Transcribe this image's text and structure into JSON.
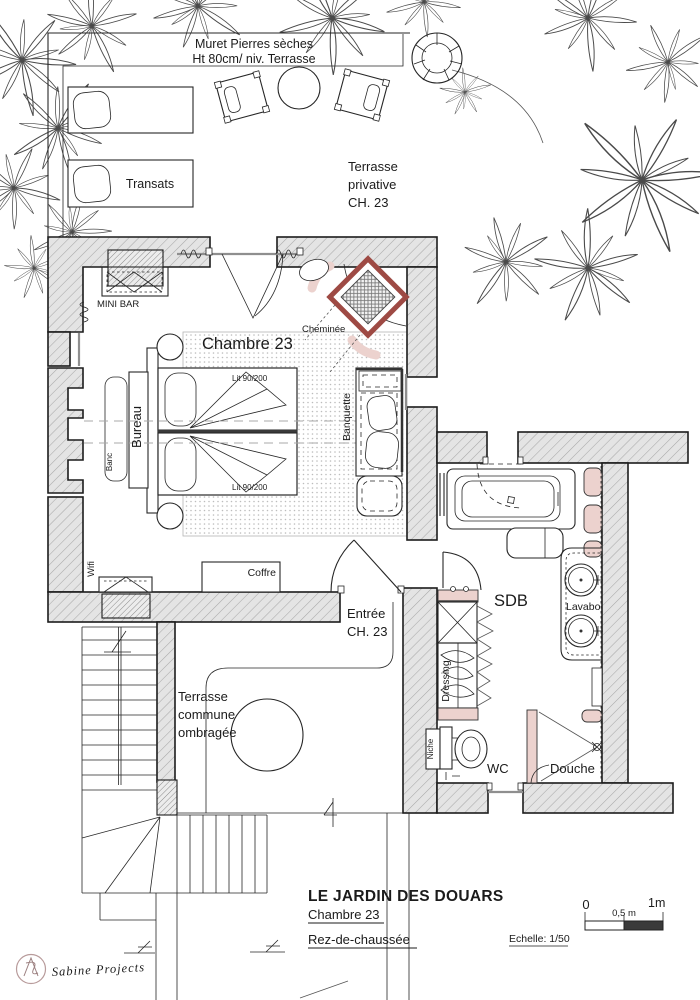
{
  "plan": {
    "terrace_top": {
      "muret_l1": "Muret Pierres sèches",
      "muret_l2": "Ht 80cm/ niv. Terrasse",
      "transats": "Transats",
      "terrasse_privative_l1": "Terrasse",
      "terrasse_privative_l2": "privative",
      "terrasse_privative_l3": "CH. 23"
    },
    "bedroom": {
      "name": "Chambre 23",
      "mini_bar": "MINI BAR",
      "cheminee": "Cheminée",
      "bed1": "Lit 90/200",
      "bed2": "Lit 90/200",
      "bureau": "Bureau",
      "banc": "Banc",
      "banquette": "Banquette",
      "wifi": "Wifi",
      "coffre": "Coffre"
    },
    "entrance": {
      "l1": "Entrée",
      "l2": "CH. 23"
    },
    "terrace_common": {
      "l1": "Terrasse",
      "l2": "commune",
      "l3": "ombragée"
    },
    "bathroom": {
      "name": "SDB",
      "lavabo": "Lavabo",
      "dressing": "Dressing",
      "niche": "Niche",
      "wc": "WC",
      "douche": "Douche"
    }
  },
  "title_block": {
    "project": "LE JARDIN DES DOUARS",
    "room": "Chambre 23",
    "level": "Rez-de-chaussée",
    "scale_label": "Echelle: 1/50",
    "scale_0": "0",
    "scale_half": "0,5 m",
    "scale_1": "1m"
  },
  "logo": {
    "brand": "Sabine Projects"
  },
  "colors": {
    "wall_fill": "#e3e3e3",
    "accent_red": "#9e4a44",
    "accent_pink": "#ecd2ce",
    "logo_red": "#a05858",
    "line": "#1f1f1f"
  }
}
